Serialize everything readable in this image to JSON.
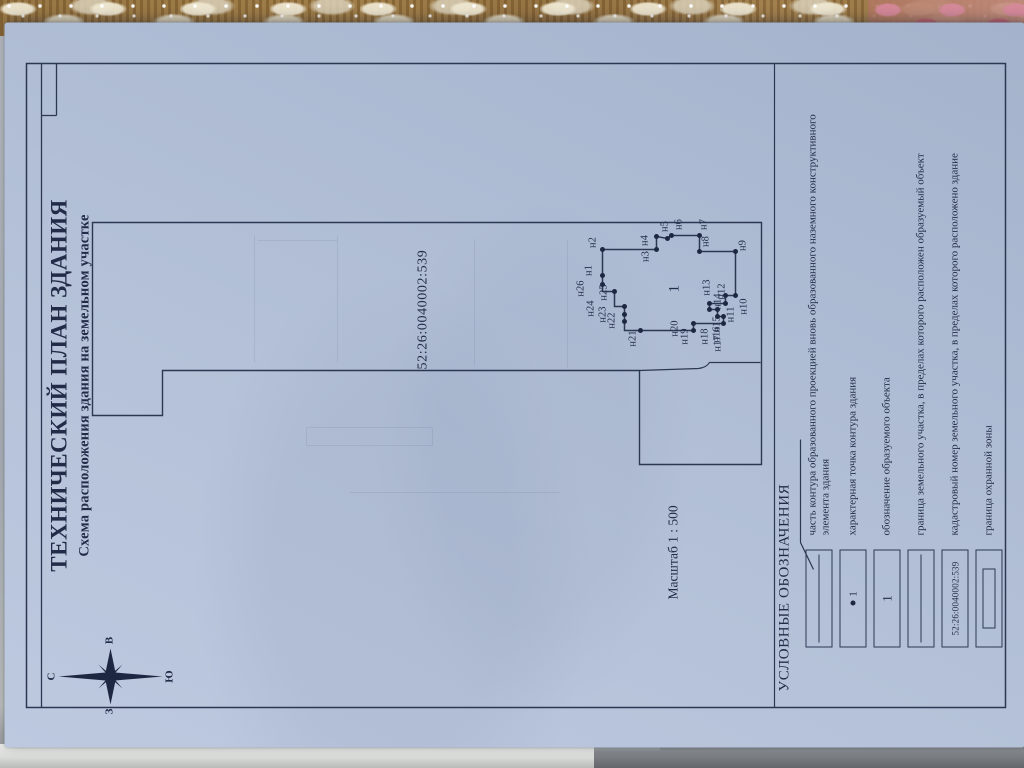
{
  "document": {
    "title": "ТЕХНИЧЕСКИЙ ПЛАН ЗДАНИЯ",
    "subtitle": "Схема расположения здания на земельном участке",
    "scale_label": "Масштаб 1 : 500",
    "cadastral_number": "52:26:0040002:539",
    "building_designation": "1"
  },
  "compass": {
    "north": "С",
    "south": "Ю",
    "west": "З",
    "east": "В"
  },
  "building_points": [
    {
      "label": "н1",
      "x": 472,
      "y": 598,
      "lx": 477,
      "ly": 585
    },
    {
      "label": "н2",
      "x": 498,
      "y": 598,
      "lx": 505,
      "ly": 589
    },
    {
      "label": "н3",
      "x": 498,
      "y": 652,
      "lx": 491,
      "ly": 642
    },
    {
      "label": "н4",
      "x": 511,
      "y": 652,
      "lx": 507,
      "ly": 641
    },
    {
      "label": "н5",
      "x": 509,
      "y": 663,
      "lx": 521,
      "ly": 661
    },
    {
      "label": "н6",
      "x": 512,
      "y": 667,
      "lx": 523,
      "ly": 675
    },
    {
      "label": "н7",
      "x": 512,
      "y": 695,
      "lx": 523,
      "ly": 700
    },
    {
      "label": "н8",
      "x": 496,
      "y": 695,
      "lx": 506,
      "ly": 702
    },
    {
      "label": "н9",
      "x": 496,
      "y": 731,
      "lx": 502,
      "ly": 739
    },
    {
      "label": "н10",
      "x": 452,
      "y": 731,
      "lx": 441,
      "ly": 740
    },
    {
      "label": "н11",
      "x": 452,
      "y": 721,
      "lx": 433,
      "ly": 727
    },
    {
      "label": "н12",
      "x": 444,
      "y": 721,
      "lx": 456,
      "ly": 718
    },
    {
      "label": "н13",
      "x": 444,
      "y": 705,
      "lx": 460,
      "ly": 703
    },
    {
      "label": "н14",
      "x": 438,
      "y": 705,
      "lx": 446,
      "ly": 714
    },
    {
      "label": "н15",
      "x": 438,
      "y": 713,
      "lx": 423,
      "ly": 713
    },
    {
      "label": "н16",
      "x": 431,
      "y": 713,
      "lx": 413,
      "ly": 713
    },
    {
      "label": "н17",
      "x": 431,
      "y": 719,
      "lx": 404,
      "ly": 714
    },
    {
      "label": "н18",
      "x": 424,
      "y": 719,
      "lx": 411,
      "ly": 701
    },
    {
      "label": "н19",
      "x": 424,
      "y": 689,
      "lx": 411,
      "ly": 681
    },
    {
      "label": "н20",
      "x": 417,
      "y": 689,
      "lx": 419,
      "ly": 671
    },
    {
      "label": "н21",
      "x": 417,
      "y": 636,
      "lx": 409,
      "ly": 629
    },
    {
      "label": "н22",
      "x": 426,
      "y": 620,
      "lx": 427,
      "ly": 608
    },
    {
      "label": "н23",
      "x": 433,
      "y": 620,
      "lx": 433,
      "ly": 599
    },
    {
      "label": "н24",
      "x": 441,
      "y": 620,
      "lx": 439,
      "ly": 587
    },
    {
      "label": "н25",
      "x": 456,
      "y": 610,
      "lx": 455,
      "ly": 600
    },
    {
      "label": "н26",
      "x": 463,
      "y": 598,
      "lx": 459,
      "ly": 577
    }
  ],
  "legend": {
    "title": "УСЛОВНЫЕ ОБОЗНАЧЕНИЯ",
    "rows": [
      {
        "symbol": "midline",
        "text": "часть контура образованного проекцией вновь образованного наземного конструктивного элемента здания"
      },
      {
        "symbol": "point",
        "symbol_text": "1",
        "text": "характерная точка контура здания"
      },
      {
        "symbol": "number",
        "symbol_text": "1",
        "text": "обозначение образуемого объекта"
      },
      {
        "symbol": "midline",
        "text": "граница земельного участка, в пределах которого расположен образуемый объект"
      },
      {
        "symbol": "cadnum",
        "symbol_text": "52:26:0040002:539",
        "text": "кадастровый номер земельного участка, в пределах которого расположено здание"
      },
      {
        "symbol": "zone",
        "text": "граница охранной зоны"
      }
    ]
  },
  "colors": {
    "ink": "#2c3752",
    "paper": "#b4c1d8"
  }
}
